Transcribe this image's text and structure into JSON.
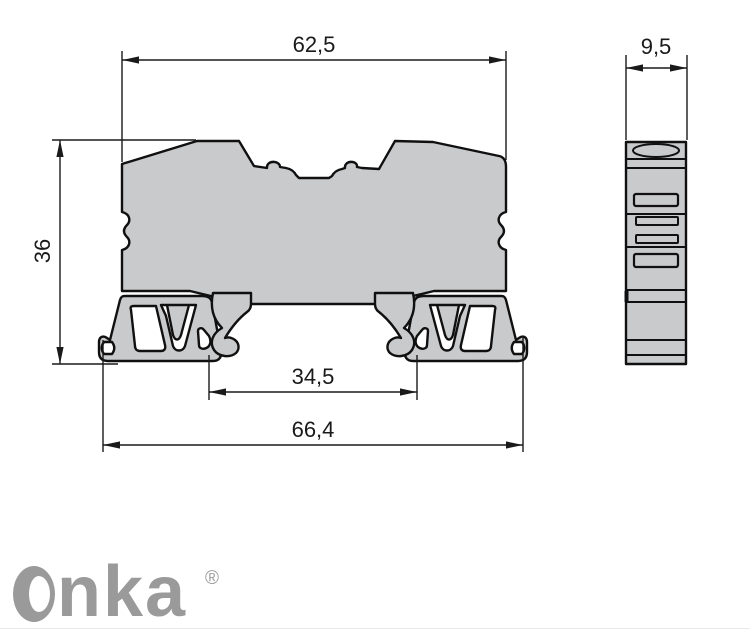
{
  "drawing": {
    "dimensions": {
      "top_width": "62,5",
      "side_width": "9,5",
      "height": "36",
      "rail_inner_width": "34,5",
      "overall_width": "66,4"
    },
    "colors": {
      "body_fill": "#c9cacc",
      "outline": "#101010",
      "dimension_color": "#1a1a1a",
      "logo_gray": "#9a9a9a"
    }
  },
  "logo": {
    "brand": "Onka",
    "brand_tail": "nka",
    "registered_mark": "®"
  }
}
